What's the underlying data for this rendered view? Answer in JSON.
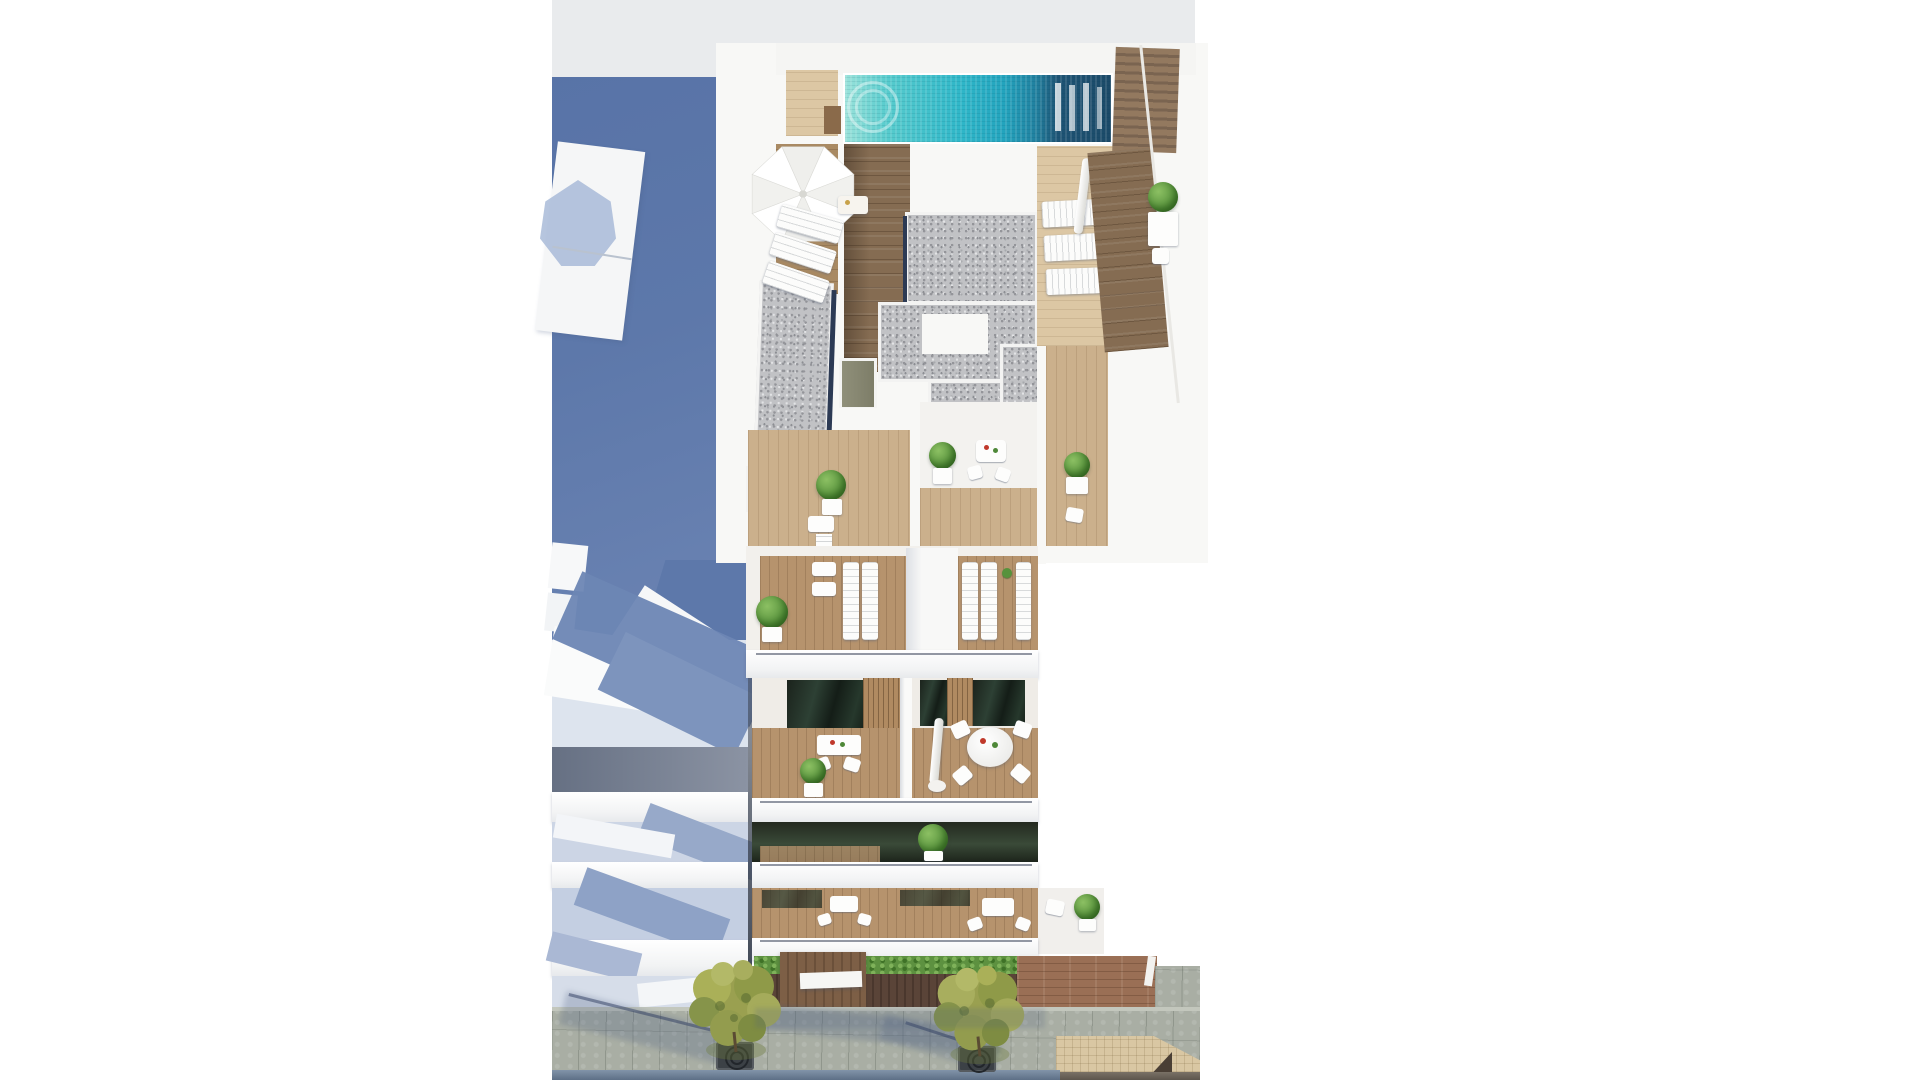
{
  "scene": {
    "type": "architectural-aerial-render",
    "description": "Aerial 3D render of a white residential building with rooftop swimming pool, sun terraces, balconies and street below",
    "labels": {
      "building": "main apartment building",
      "neighbor": "adjacent building with balconies",
      "pool": "rooftop swimming pool",
      "pool_deck": "wooden pool deck",
      "parasol": "white patio parasol",
      "sun_loungers": "white sun loungers",
      "gravel_roof": "gravel roof panels",
      "terrace": "wooden roof terrace",
      "balcony": "apartment balcony with furniture",
      "street_tree": "street tree in pavement grate",
      "sidewalk": "stone slab sidewalk",
      "road": "asphalt road edge",
      "cast_shadow": "blue building shadow",
      "entrance_canopy": "wooden entrance canopy"
    }
  },
  "palette": {
    "white": "#f8f8f6",
    "sky_gray": "#e9ebed",
    "shadow_blue": "#5b76a9",
    "shadow_blue_light": "#8fa3c4",
    "pool_aqua": "#2eb6c8",
    "pool_deep": "#1d4e6b",
    "wood_dark": "#856c52",
    "wood_light": "#cbb08c",
    "gravel_gray": "#c1c2c5",
    "glass_green": "#22301f",
    "plant_green": "#57923c",
    "tree_olive": "#9aa050",
    "sidewalk_gray": "#a9aea4",
    "terracotta": "#9a6f55",
    "beige_tile": "#d9c7a3",
    "accent_red": "#c0392b",
    "door_olive": "#8f8f78"
  }
}
